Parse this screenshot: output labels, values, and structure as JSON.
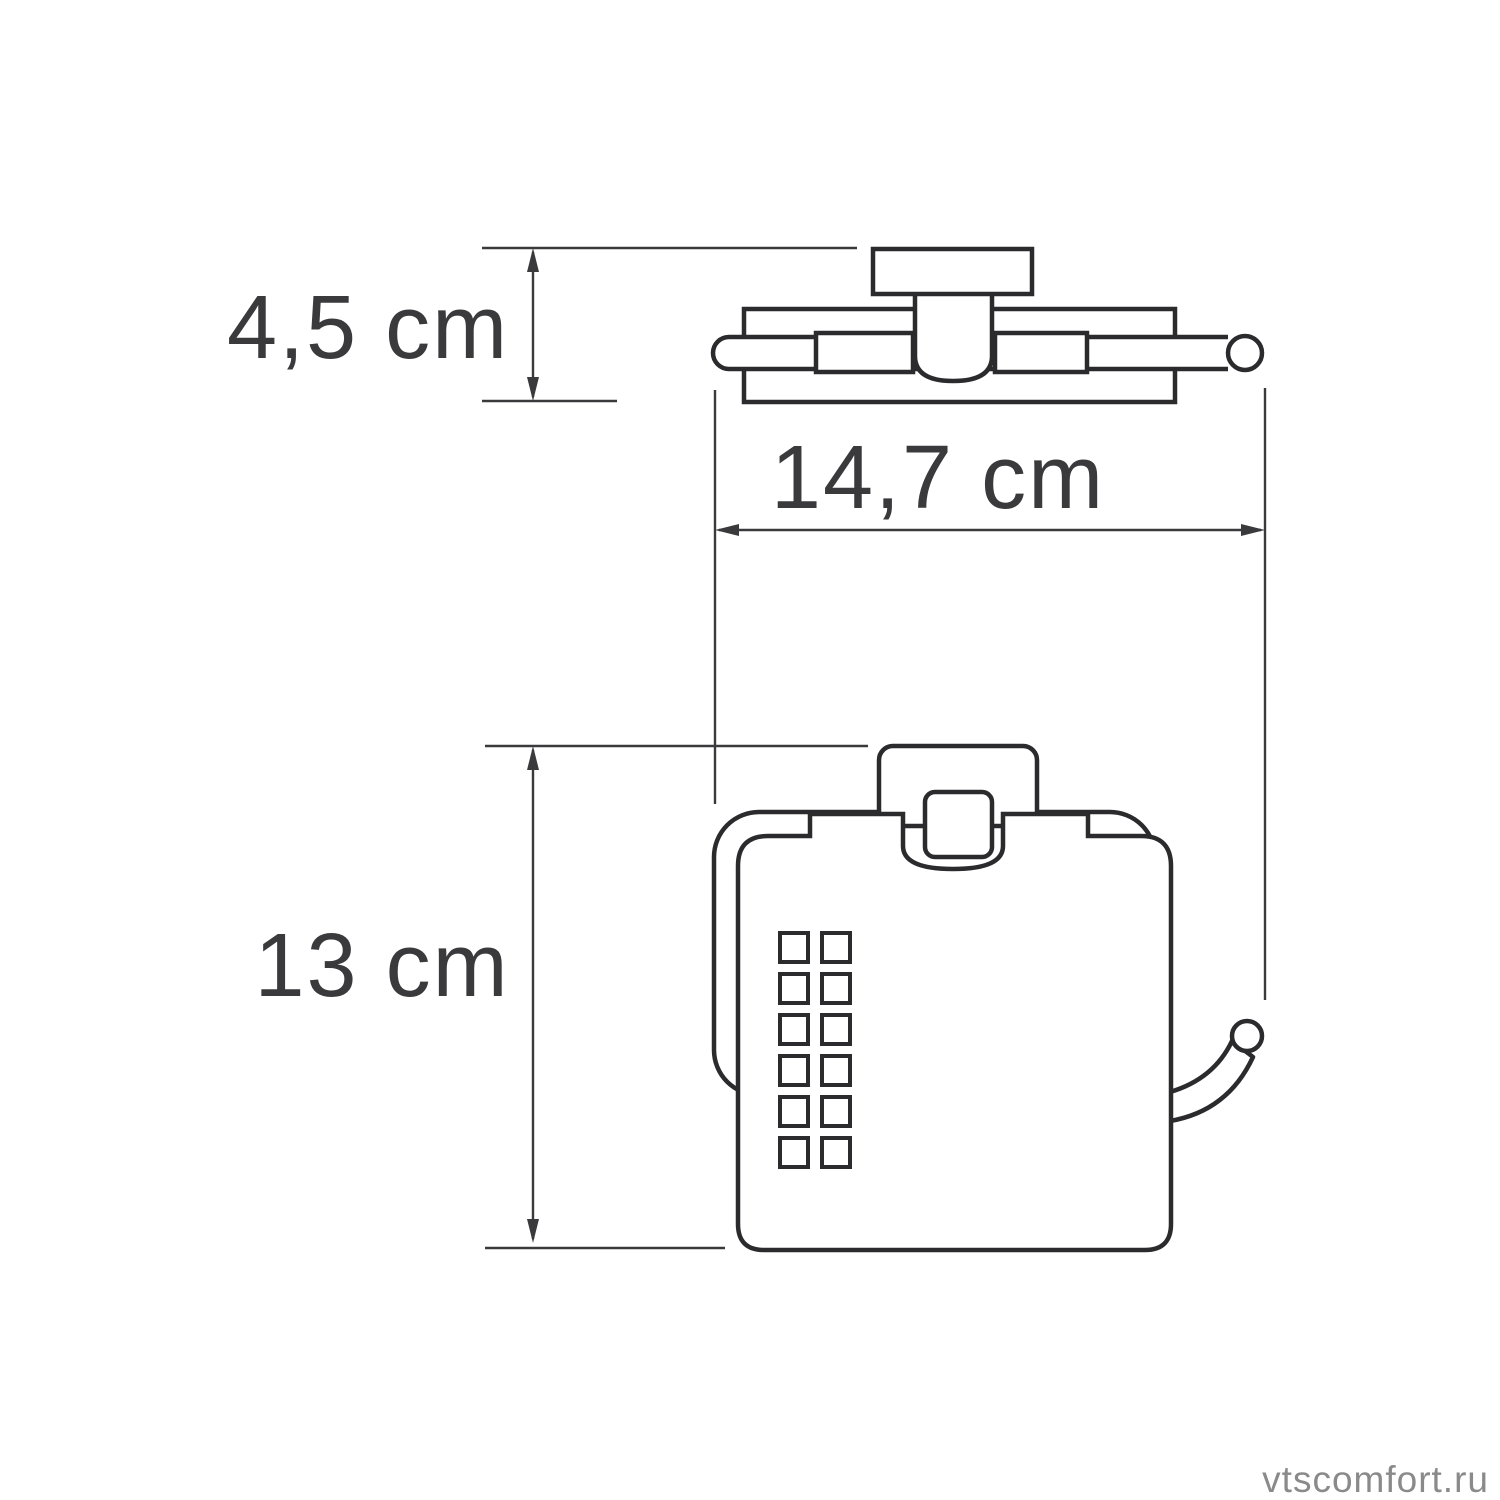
{
  "page": {
    "background": "#ffffff"
  },
  "drawing": {
    "line_color": "#2b2b2e",
    "dimension_color": "#3a3a3c",
    "dimensions": {
      "depth": {
        "label": "4,5 cm"
      },
      "width": {
        "label": "14,7 cm"
      },
      "height": {
        "label": "13 cm"
      }
    }
  },
  "watermark": {
    "text": "vtscomfort.ru",
    "color": "#8a8a8a"
  }
}
